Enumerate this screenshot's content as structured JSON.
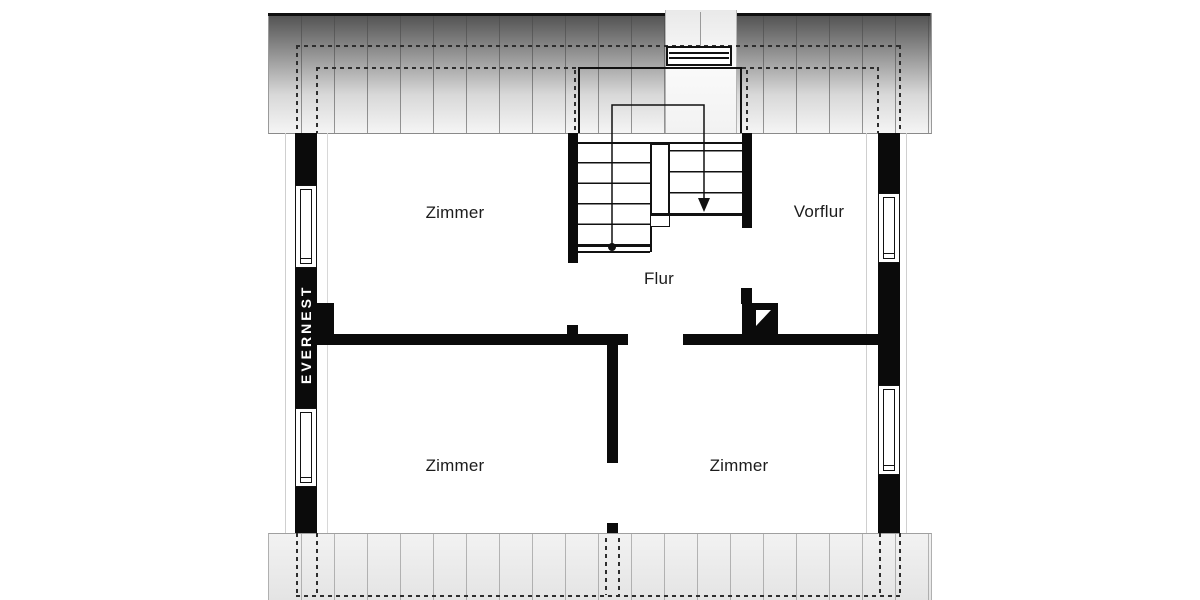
{
  "plan": {
    "brand": {
      "logo_text": "EVERNEST"
    },
    "rooms": [
      {
        "id": "zimmer-top-left",
        "label": "Zimmer"
      },
      {
        "id": "vorflur",
        "label": "Vorflur"
      },
      {
        "id": "flur",
        "label": "Flur"
      },
      {
        "id": "zimmer-bottom-left",
        "label": "Zimmer"
      },
      {
        "id": "zimmer-bottom-right",
        "label": "Zimmer"
      }
    ],
    "icons": {
      "stair_direction_arrow": "▼",
      "walkline_start_dot": "●",
      "chimney_flue": "white-triangle"
    },
    "colors": {
      "wall": "#0b0b0b",
      "roof_gradient_dark": "#4f4f4f",
      "roof_gradient_light": "#f5f5f5",
      "bottom_band_light": "#f2f2f2",
      "bottom_band_dark": "#e4e4e4",
      "dashed_line": "#2e2e2e",
      "hatch_line": "#8a8a8a",
      "label_text": "#1c1c1c",
      "logo_text": "#ffffff",
      "background": "#ffffff"
    }
  }
}
